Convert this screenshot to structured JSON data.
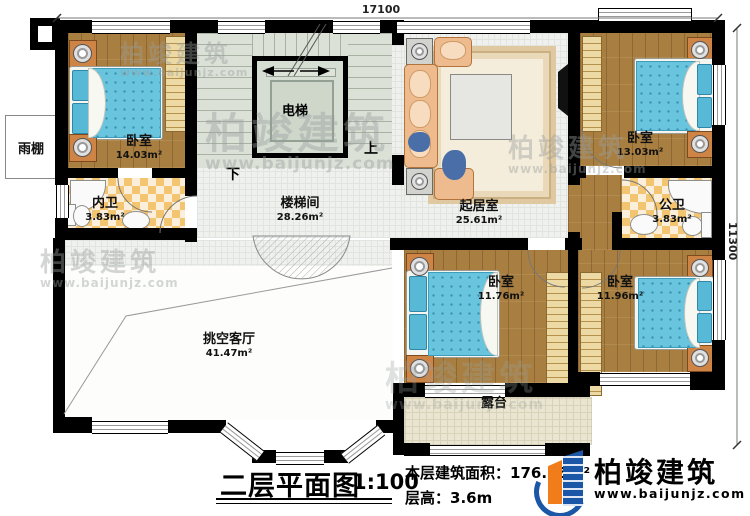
{
  "dims": {
    "top": "17100",
    "right": "11300"
  },
  "stair": {
    "up": "上",
    "down": "下",
    "elevator": "电梯"
  },
  "rooms": {
    "bedroom_tl": {
      "name": "卧室",
      "area": "14.03m²"
    },
    "inner_bath": {
      "name": "内卫",
      "area": "3.83m²"
    },
    "stair_hall": {
      "name": "楼梯间",
      "area": "28.26m²"
    },
    "living": {
      "name": "起居室",
      "area": "25.61m²"
    },
    "bedroom_tr": {
      "name": "卧室",
      "area": "13.03m²"
    },
    "public_bath": {
      "name": "公卫",
      "area": "3.83m²"
    },
    "bedroom_bm": {
      "name": "卧室",
      "area": "11.76m²"
    },
    "bedroom_br": {
      "name": "卧室",
      "area": "11.96m²"
    },
    "void_living": {
      "name": "挑空客厅",
      "area": "41.47m²"
    },
    "terrace": {
      "name": "露台"
    },
    "canopy": {
      "name": "雨棚"
    }
  },
  "footer": {
    "title": "二层平面图",
    "scale": "1:100",
    "floor_area_label": "本层建筑面积：",
    "floor_area_value": "176.35m²",
    "floor_height_label": "层高：",
    "floor_height_value": "3.6m"
  },
  "brand": {
    "name": "柏竣建筑",
    "url": "www.baijunjz.com"
  },
  "colors": {
    "wall": "#000000",
    "wood_floor": "#a97f41",
    "mattress_blue": "#69c4dd",
    "checker_gold": "#f3c571",
    "stair_green": "#dbe1d7",
    "terrace_beige": "#e9e5d0",
    "brand_blue": "#1b57a6",
    "brand_orange": "#f07d1a"
  }
}
